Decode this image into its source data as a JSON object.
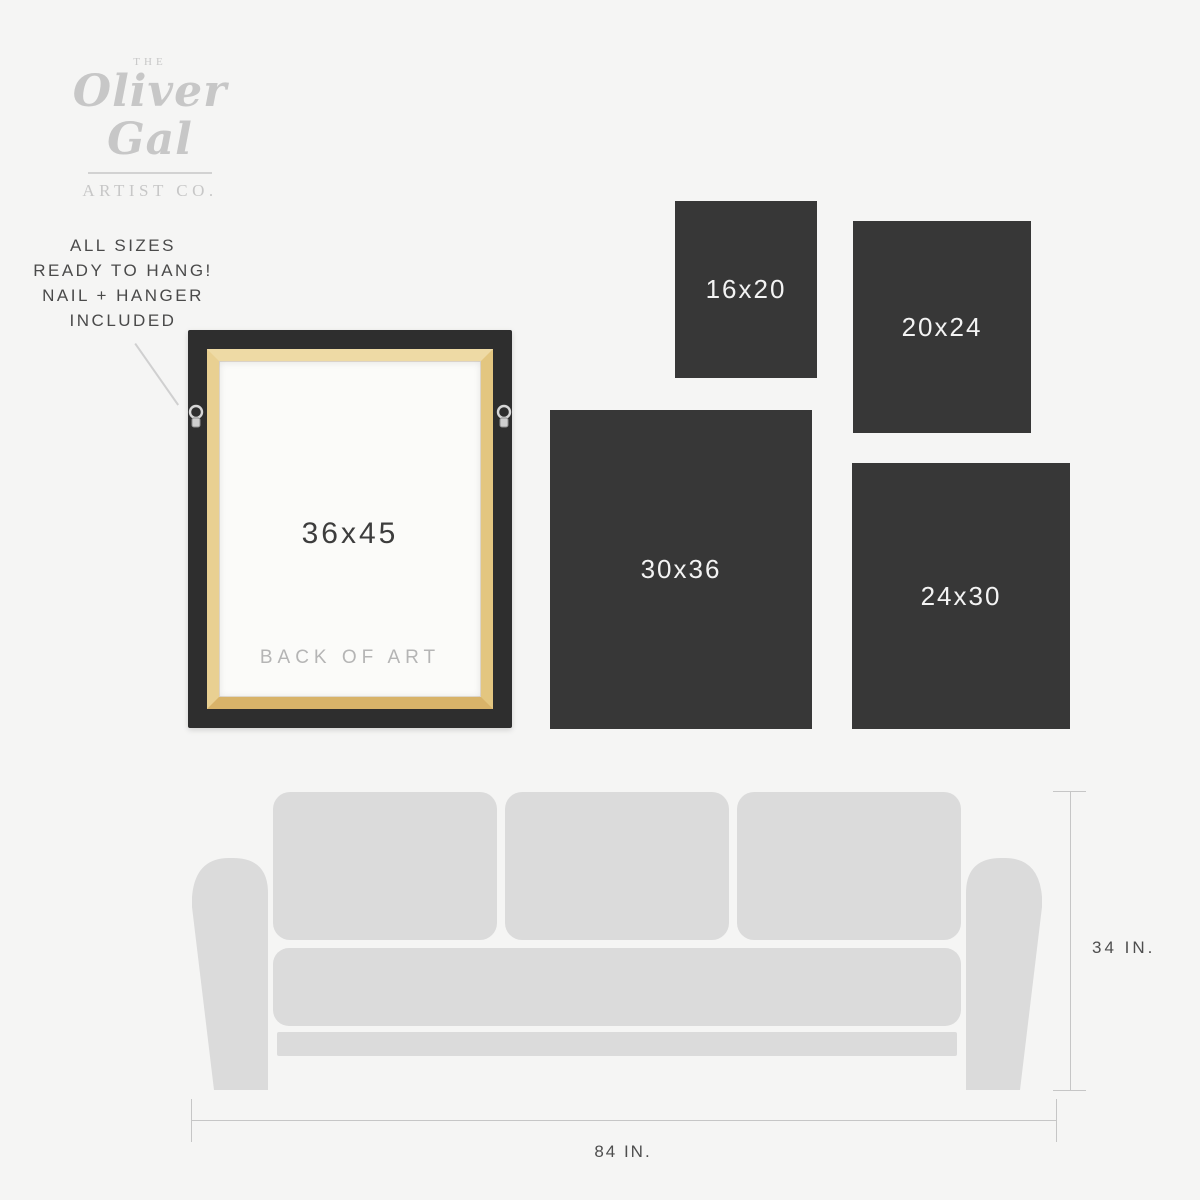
{
  "brand": {
    "pre": "THE",
    "name": "Oliver Gal",
    "sub": "ARTIST CO."
  },
  "hang_note": {
    "lines": [
      "ALL SIZES",
      "READY TO HANG!",
      "NAIL + HANGER",
      "INCLUDED"
    ]
  },
  "featured": {
    "size": "36x45",
    "caption": "BACK OF ART"
  },
  "sizes": [
    {
      "label": "16x20"
    },
    {
      "label": "20x24"
    },
    {
      "label": "30x36"
    },
    {
      "label": "24x30"
    }
  ],
  "sofa": {
    "height": "34 IN.",
    "width": "84 IN."
  },
  "colors": {
    "background": "#f5f5f4",
    "tile": "#373737",
    "tile_text": "#f3f3f3",
    "sofa": "#dbdbdb",
    "frame_black": "#2e2e2e",
    "frame_wood": "#e3c680",
    "logo_gray": "#c7c7c7",
    "text_dark": "#4a4a4a",
    "caption_muted": "#b5b5b5",
    "measure_line": "#c6c6c6"
  }
}
